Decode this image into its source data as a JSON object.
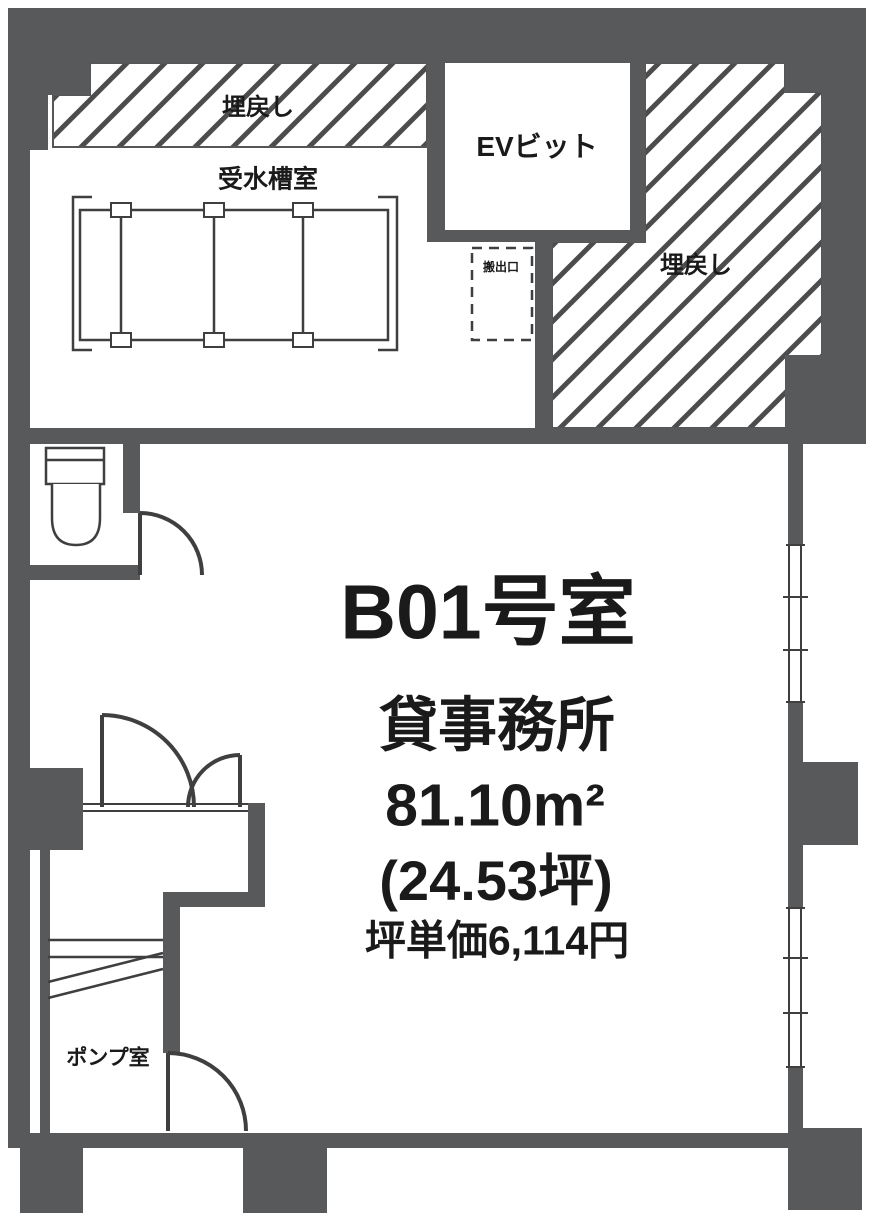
{
  "plan": {
    "unit": {
      "room_number": "B01号室",
      "usage": "貸事務所",
      "area_sqm": "81.10m²",
      "area_tsubo": "(24.53坪)",
      "unit_price": "坪単価6,114円"
    },
    "rooms": {
      "backfill_top": "埋戻し",
      "backfill_right": "埋戻し",
      "water_tank_room": "受水槽室",
      "ev_pit": "EVビット",
      "hatch_opening": "搬出口",
      "pump_room": "ポンプ室"
    },
    "colors": {
      "wall": "#58595b",
      "line": "#3f3f3f",
      "hatch": "#4c4c4c",
      "text": "#1a1a1a",
      "background": "#ffffff"
    }
  }
}
